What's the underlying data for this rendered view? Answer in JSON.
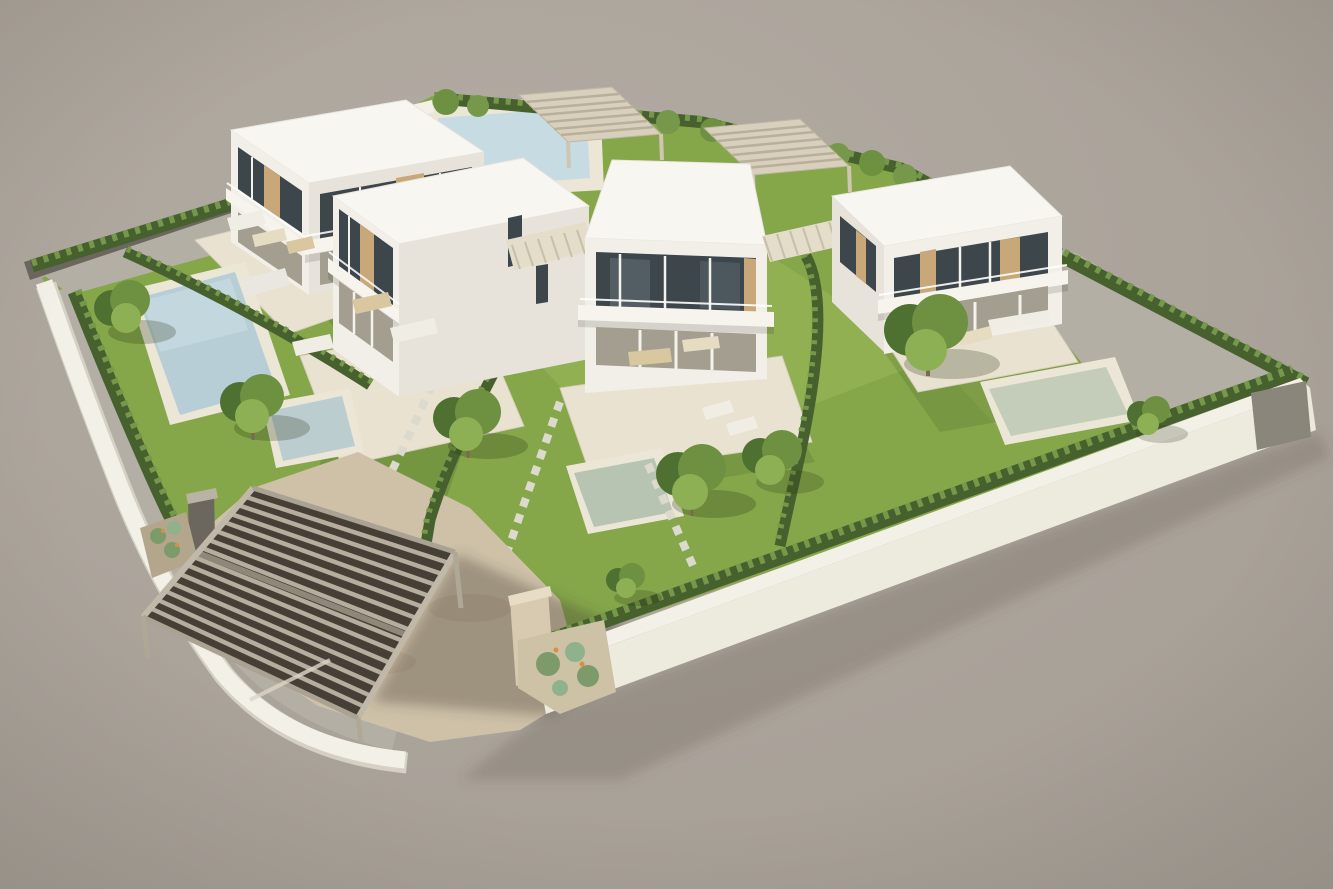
{
  "scene": {
    "kind": "3d-architectural-rendering",
    "subject": "Aerial 3D rendering of a gated residential plot with four modern white flat-roof villas, private lawned gardens with swimming pools, hedge boundaries, stepping-stone paths, garden pergolas and a slatted carport pergola at the entrance",
    "villa_count": 4,
    "swimming_pool_count": 5,
    "objects": [
      "villa",
      "flat-roof",
      "balcony",
      "covered-terrace",
      "glazed-facade",
      "wood-slat-shutters",
      "garden-lawn",
      "boundary-hedge",
      "divider-hedge",
      "perimeter-wall",
      "gravel-path",
      "swimming-pool",
      "pool-deck",
      "stepping-stone-path",
      "tree",
      "agave-planter",
      "outdoor-sofa",
      "dining-table",
      "sun-lounger",
      "exterior-stairs",
      "garden-pergola",
      "carport-pergola",
      "driveway",
      "entrance-gate-pillar"
    ]
  },
  "palette": {
    "bg1": "#b3aca3",
    "bg2": "#a59e95",
    "lawn": "#85a74a",
    "lawnLight": "#9dbd5d",
    "lawnShade": "#5f7f36",
    "hedge": "#46612e",
    "hedgeLight": "#76984a",
    "gravel": "#b4afa5",
    "paving": "#e9e2d0",
    "pavingShade": "#d6cfba",
    "drive": "#cec1a8",
    "driveShade": "#a2957d",
    "wallWhite": "#f3f0e8",
    "wallShade": "#d6d1c4",
    "wallDark": "#6b665e",
    "wallFace": "#edeade",
    "roof": "#f7f6f1",
    "faceLight": "#f2efe8",
    "faceMid": "#e7e3da",
    "faceShade": "#cfcabf",
    "glass": "#3d464b",
    "glassLight": "#66737a",
    "wood": "#c8a878",
    "balcony": "#f6f4ed",
    "porch": "#a49e90",
    "poolBlue": "#b7ced6",
    "poolTeal": "#bccdd0",
    "poolGreen": "#b8c4b2",
    "poolPale": "#c3cdba",
    "poolDeck": "#ebe6d6",
    "slat": "#b5ad9e",
    "slatDark": "#8f887a",
    "carport": "#463f36",
    "treeDark": "#4e7030",
    "treeMid": "#6d9140",
    "treeLight": "#8cb053",
    "trunk": "#7b6a50",
    "stone": "#d8cab0",
    "agave": "#7d9a6b",
    "furnWhite": "#f0ede4",
    "furnBeige": "#e6dcc2",
    "furnWood": "#d9c7a0"
  }
}
